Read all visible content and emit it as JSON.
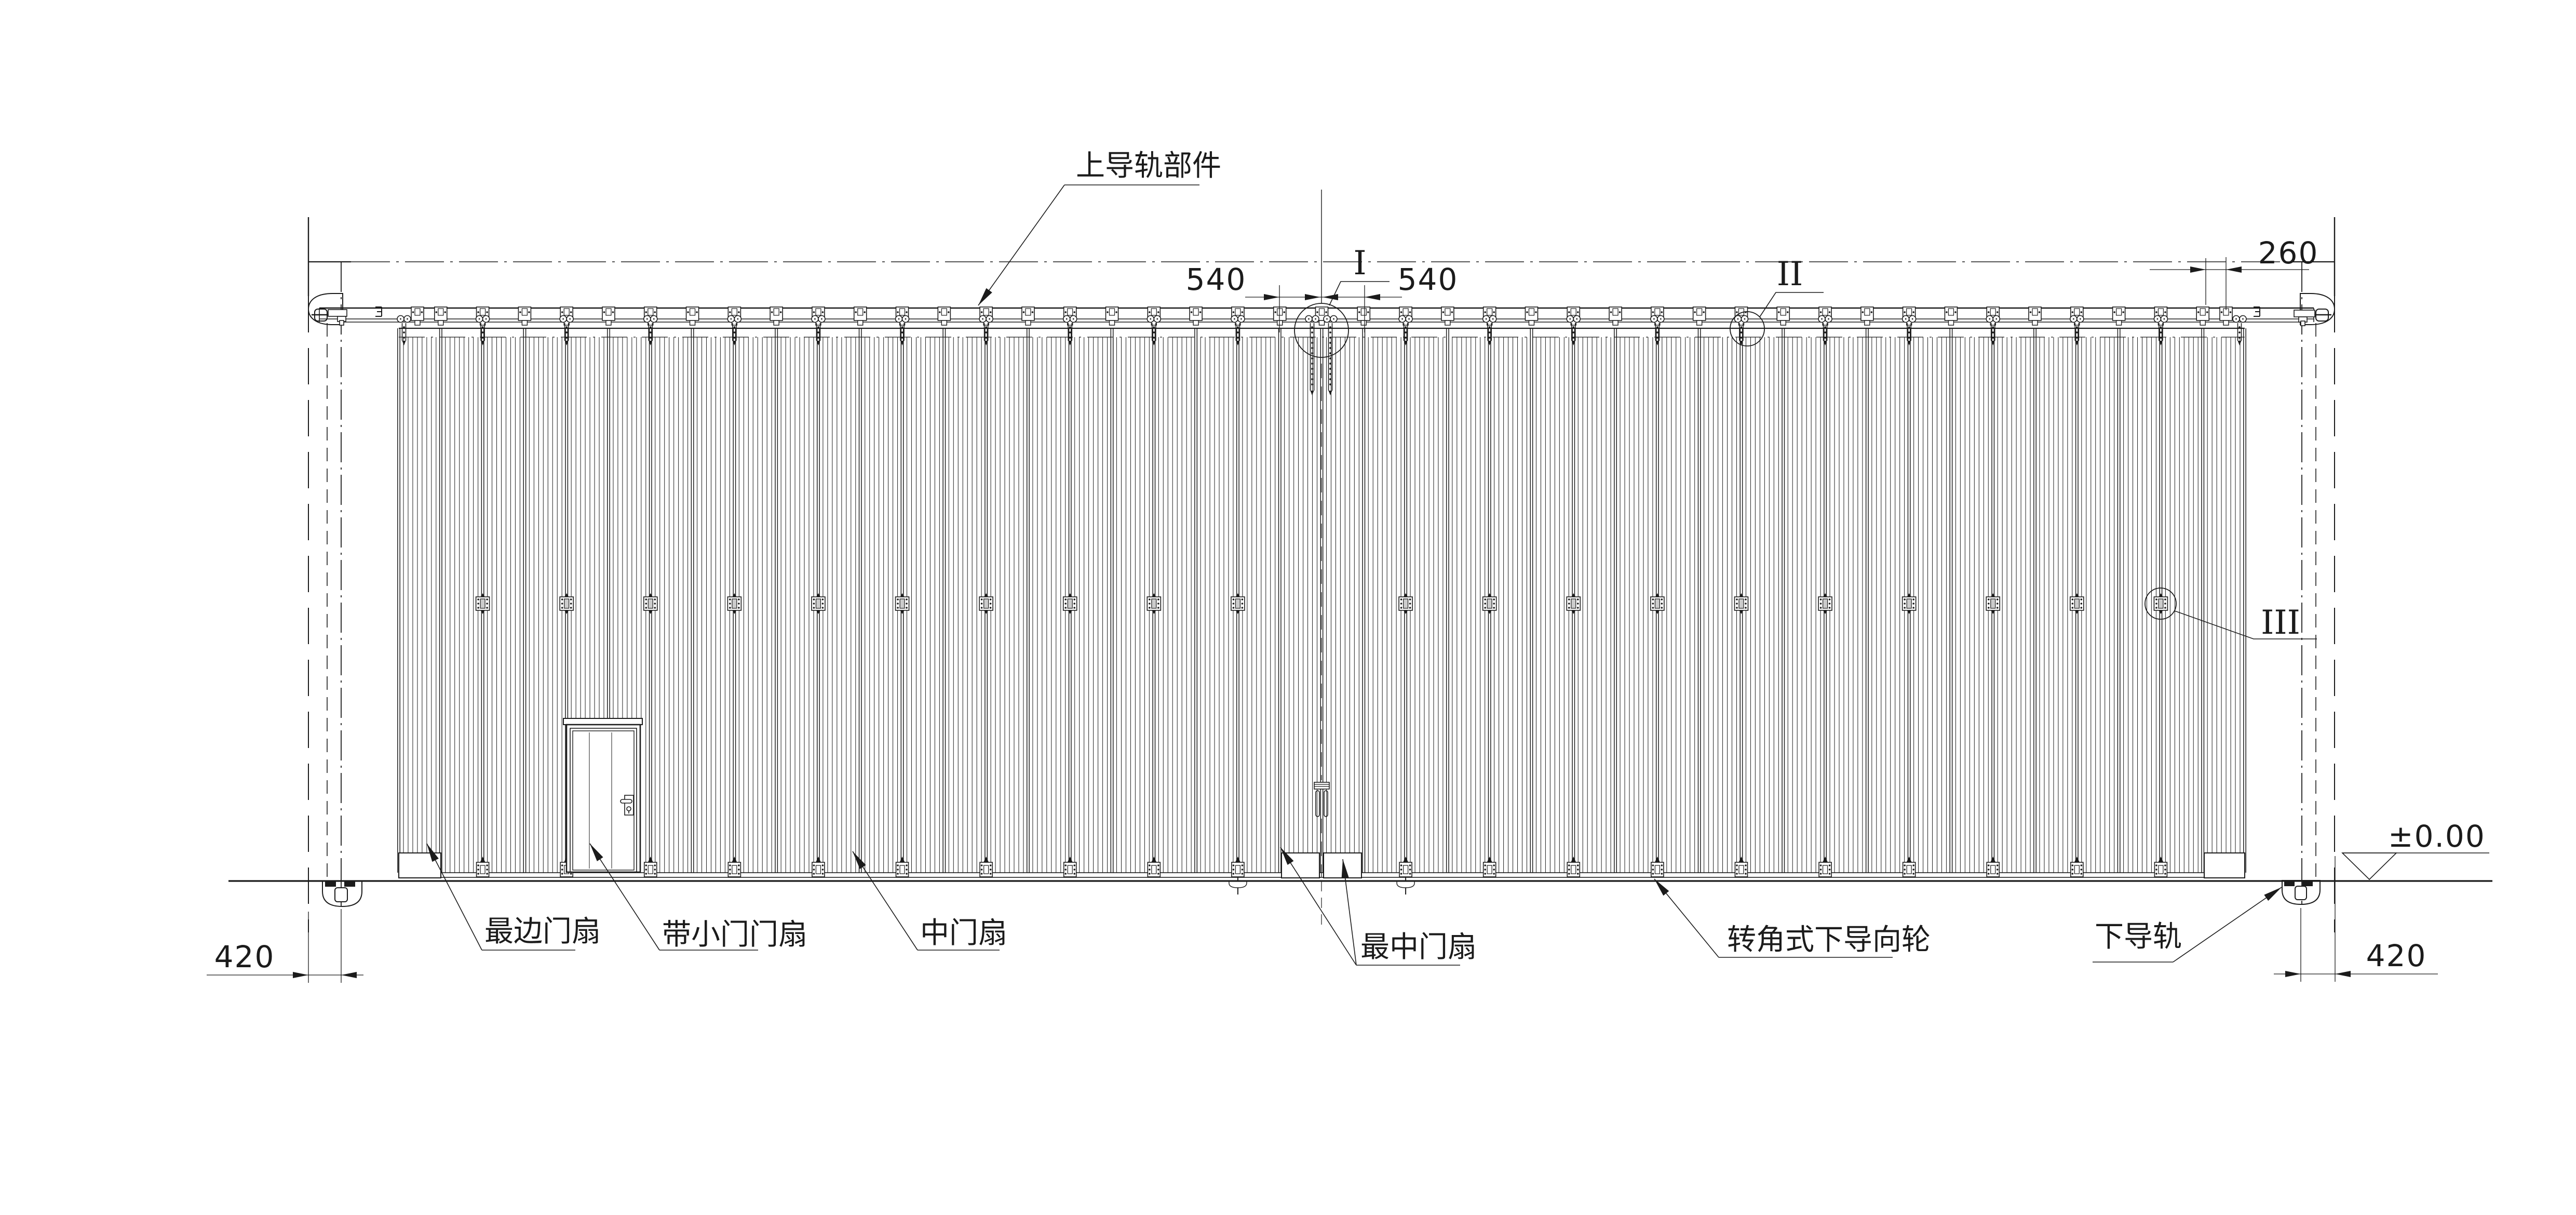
{
  "labels": {
    "top_rail": "上导轨部件",
    "edge_leaf": "最边门扇",
    "wicket_leaf": "带小门门扇",
    "middle_leaf": "中门扇",
    "center_leaf": "最中门扇",
    "corner_guide_wheel": "转角式下导向轮",
    "bottom_rail": "下导轨"
  },
  "dimensions": {
    "bay_left": "540",
    "bay_right": "540",
    "end_offset": "260",
    "pocket_left": "420",
    "pocket_right": "420"
  },
  "level_mark": "±0.00",
  "section_marks": {
    "i": "I",
    "ii": "II",
    "iii": "III"
  },
  "colors": {
    "line": "#1b1b1b",
    "background": "#ffffff"
  }
}
